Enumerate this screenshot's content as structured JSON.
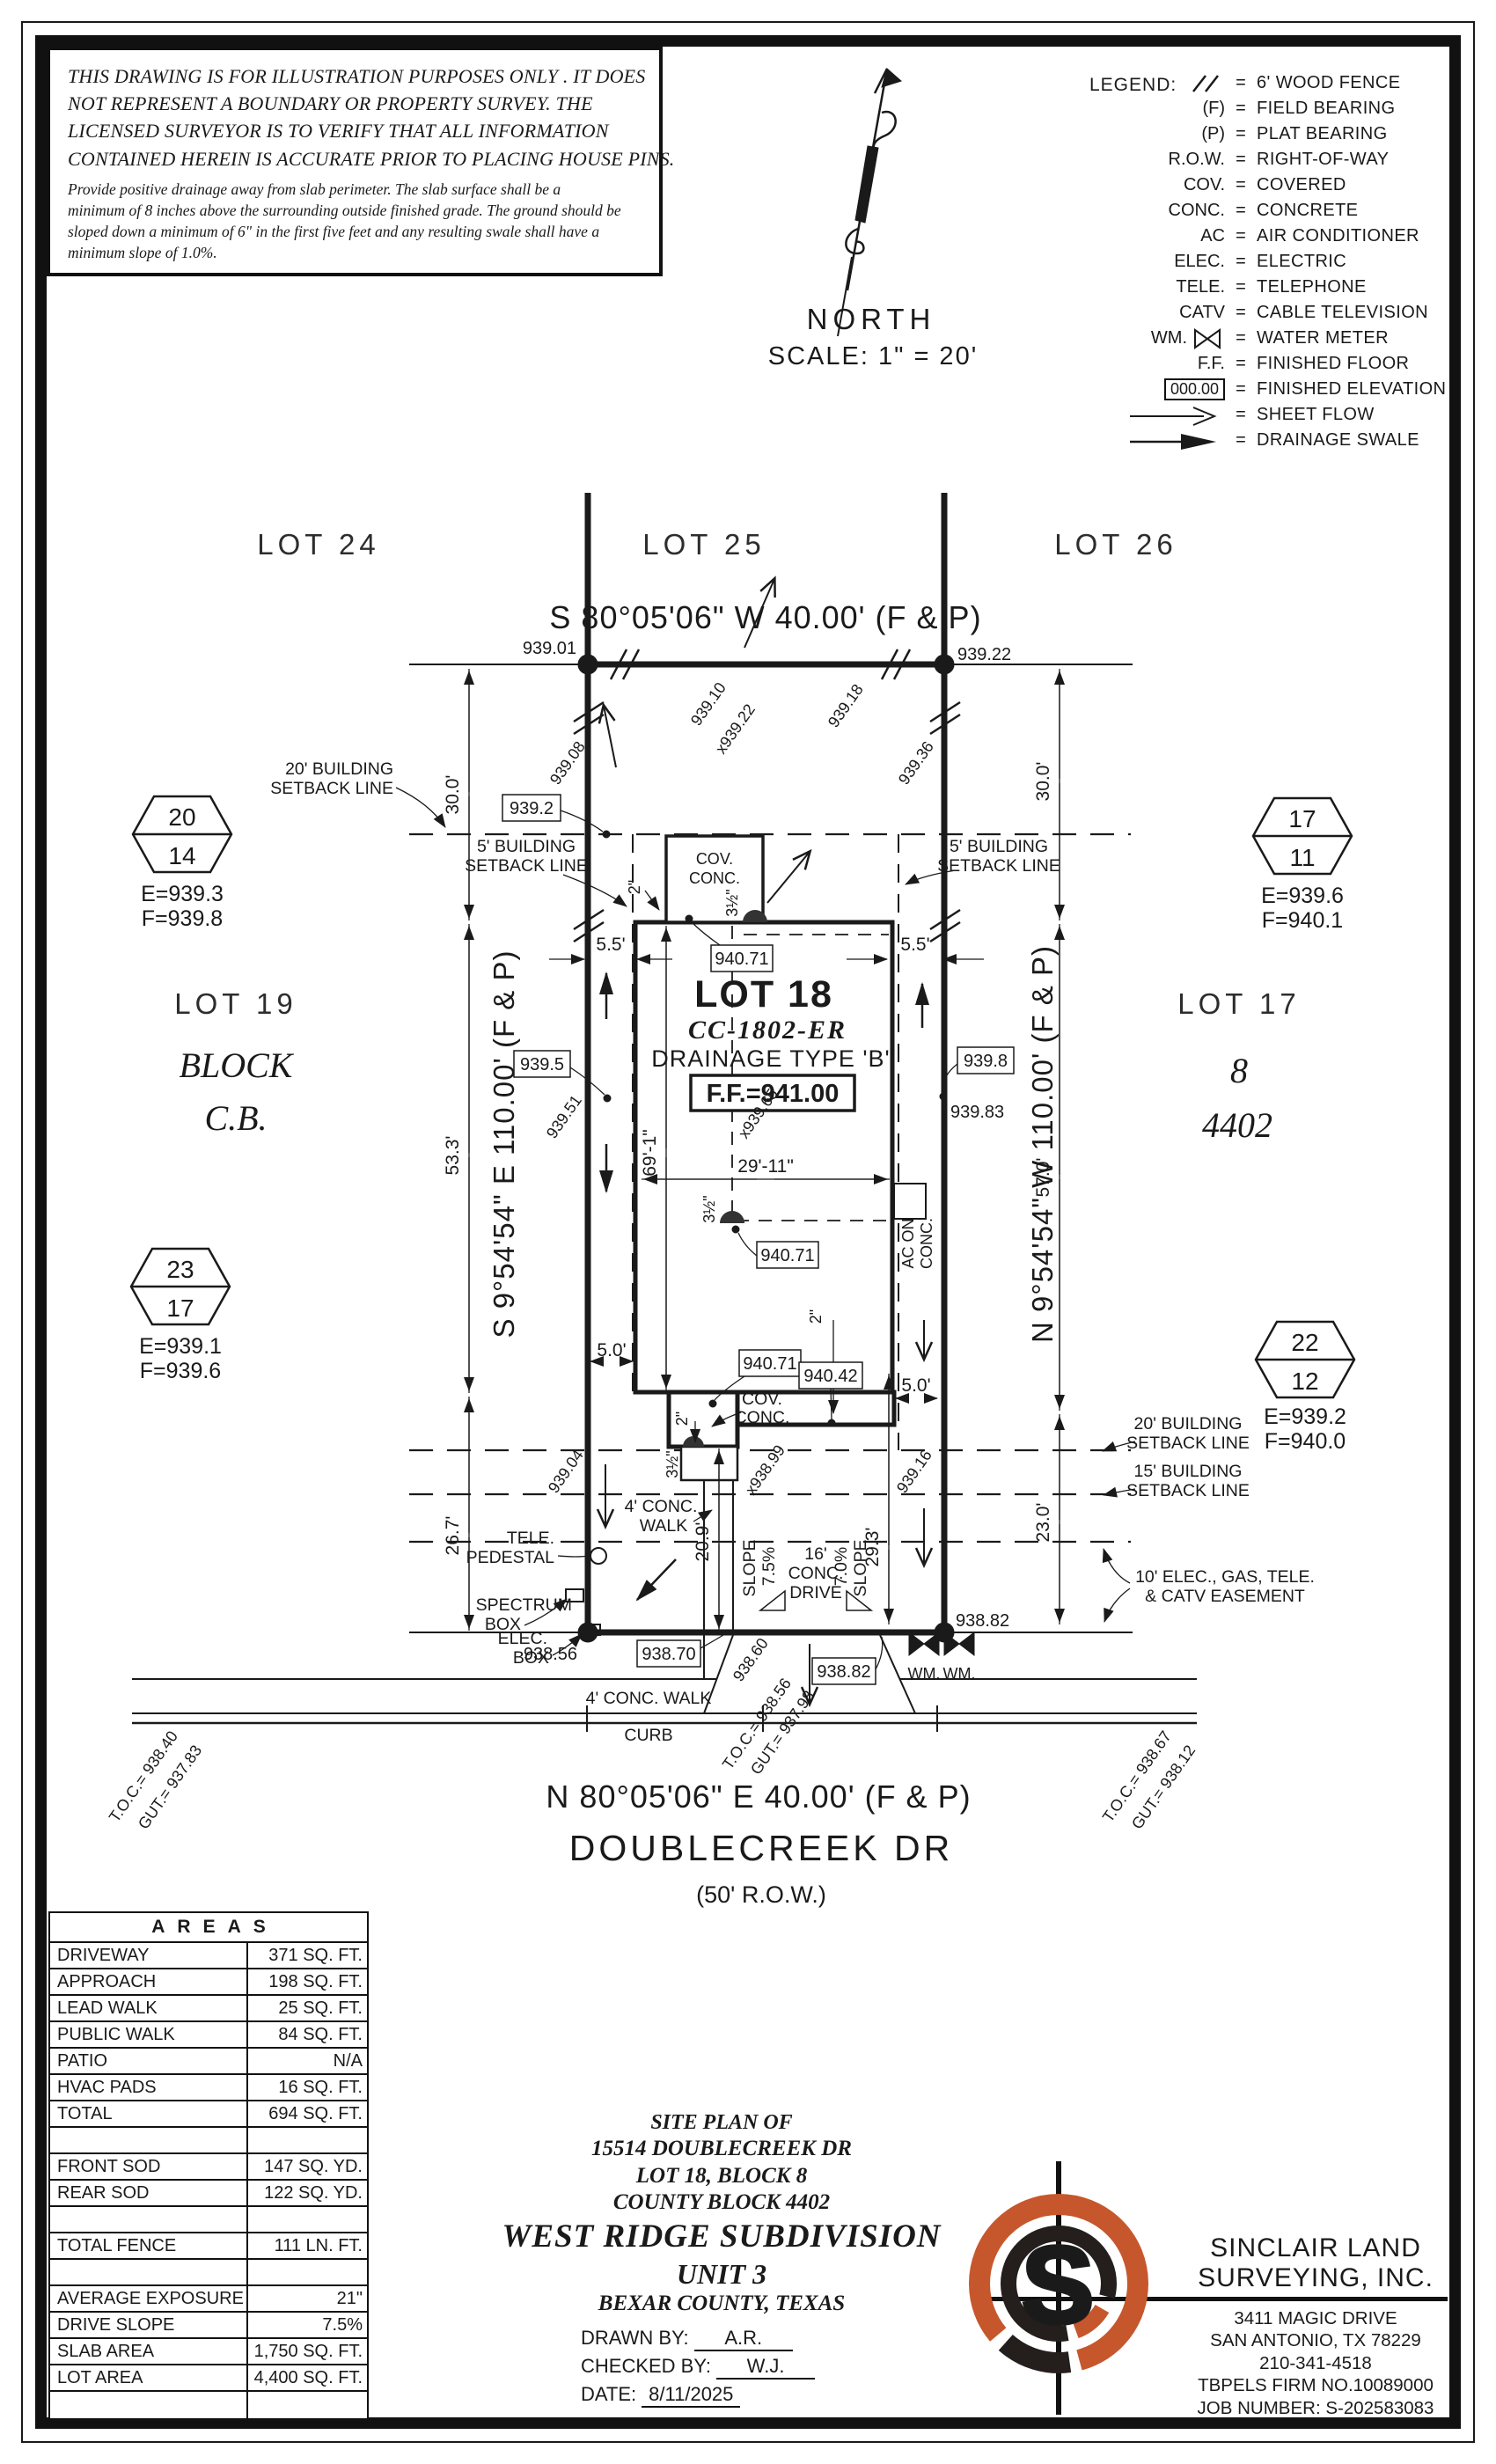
{
  "colors": {
    "ink": "#1a1a1a",
    "brand_orange": "#c6572c"
  },
  "disclaimer": {
    "caps": [
      "THIS DRAWING IS FOR ILLUSTRATION PURPOSES ONLY . IT DOES",
      "NOT REPRESENT A BOUNDARY OR PROPERTY SURVEY. THE",
      "LICENSED SURVEYOR IS TO VERIFY THAT ALL INFORMATION",
      "CONTAINED HEREIN IS ACCURATE PRIOR TO PLACING HOUSE PINS."
    ],
    "small": [
      "Provide positive drainage away from slab perimeter. The slab surface shall be a",
      "minimum of 8 inches above the surrounding outside finished grade. The ground should be",
      "sloped down a minimum of 6\" in the first five feet and any resulting swale shall have a",
      "minimum slope of 1.0%."
    ]
  },
  "north": {
    "label": "NORTH",
    "scale": "SCALE:  1\" =  20'"
  },
  "legend": {
    "title": "LEGEND:",
    "eq": "=",
    "rows": [
      {
        "sym": "",
        "label": "6' WOOD FENCE"
      },
      {
        "sym": "(F)",
        "label": "FIELD BEARING"
      },
      {
        "sym": "(P)",
        "label": "PLAT BEARING"
      },
      {
        "sym": "R.O.W.",
        "label": "RIGHT-OF-WAY"
      },
      {
        "sym": "COV.",
        "label": "COVERED"
      },
      {
        "sym": "CONC.",
        "label": "CONCRETE"
      },
      {
        "sym": "AC",
        "label": "AIR CONDITIONER"
      },
      {
        "sym": "ELEC.",
        "label": "ELECTRIC"
      },
      {
        "sym": "TELE.",
        "label": "TELEPHONE"
      },
      {
        "sym": "CATV",
        "label": "CABLE TELEVISION"
      },
      {
        "sym": "WM.",
        "label": "WATER METER"
      },
      {
        "sym": "F.F.",
        "label": "FINISHED FLOOR"
      },
      {
        "sym": "000.00",
        "label": "FINISHED ELEVATION"
      },
      {
        "sym": "",
        "label": "SHEET FLOW"
      },
      {
        "sym": "",
        "label": "DRAINAGE SWALE"
      }
    ]
  },
  "plan": {
    "lots": {
      "lot24": "LOT 24",
      "lot25": "LOT 25",
      "lot26": "LOT 26",
      "lot19": "LOT 19",
      "block_word": "BLOCK",
      "block_cb": "C.B.",
      "lot17": "LOT 17",
      "block8": "8",
      "cb4402": "4402"
    },
    "bearings": {
      "top": "S 80°05'06\" W 40.00' (F & P)",
      "bottom": "N 80°05'06\" E 40.00' (F & P)",
      "left": "S 9°54'54\" E 110.00' (F & P)",
      "right": "N 9°54'54\" W 110.00' (F & P)"
    },
    "street": {
      "name": "DOUBLECREEK DR",
      "row": "(50' R.O.W.)"
    },
    "house": {
      "lot": "LOT 18",
      "plan_no": "CC-1802-ER",
      "drainage": "DRAINAGE TYPE 'B'",
      "ff": "F.F.=941.00"
    },
    "setbacks": {
      "b20": "20' BUILDING",
      "b15": "15' BUILDING",
      "b5": "5' BUILDING",
      "sl": "SETBACK LINE",
      "e1": "10' ELEC., GAS, TELE.",
      "e2": "& CATV EASEMENT"
    },
    "dims": {
      "d30": "30.0'",
      "d533": "53.3'",
      "d267": "26.7'",
      "d57": "57.0'",
      "d23": "23.0'",
      "d209": "20.9'",
      "d293": "29.3'",
      "d55": "5.5'",
      "d50": "5.0'",
      "d2911": "29'-11\"",
      "d691": "69'-1\"",
      "d2": "2\"",
      "d35": "3½\""
    },
    "features": {
      "cov": "COV.",
      "conc": "CONC.",
      "acon": "AC ON",
      "tele": "TELE.",
      "ped": "PEDESTAL",
      "spectrum": "SPECTRUM",
      "box": "BOX",
      "elec": "ELEC.",
      "walk": "4' CONC. WALK",
      "walk1": "4' CONC.",
      "walk2": "WALK",
      "curb": "CURB",
      "slope": "SLOPE",
      "s75": "7.5%",
      "s70": "7.0%",
      "dr1": "16'",
      "dr2": "CONC.",
      "dr3": "DRIVE",
      "wm": "WM."
    },
    "spots_boxed": {
      "b1": "939.2",
      "b2": "940.71",
      "b3": "940.42",
      "b4": "939.5",
      "b5": "939.8",
      "b6": "938.70",
      "b7": "938.82"
    },
    "spots": {
      "c1": "939.01",
      "c2": "939.22",
      "c3": "938.56",
      "c4": "938.82",
      "c5": "939.83",
      "d1": "939.08",
      "d2": "939.10",
      "d3": "x939.22",
      "d4": "939.18",
      "d5": "939.36",
      "d6": "939.51",
      "d7": "x939.65",
      "d8": "939.04",
      "d9": "x938.99",
      "d10": "939.16",
      "d11": "938.60"
    },
    "markers": {
      "m1": {
        "n1": "20",
        "n2": "14",
        "e": "E=939.3",
        "f": "F=939.8"
      },
      "m2": {
        "n1": "23",
        "n2": "17",
        "e": "E=939.1",
        "f": "F=939.6"
      },
      "m3": {
        "n1": "17",
        "n2": "11",
        "e": "E=939.6",
        "f": "F=940.1"
      },
      "m4": {
        "n1": "22",
        "n2": "12",
        "e": "E=939.2",
        "f": "F=940.0"
      }
    },
    "toc": [
      {
        "a": "T.O.C.= 938.40",
        "b": "GUT.= 937.83"
      },
      {
        "a": "T.O.C.= 938.56",
        "b": "GUT.= 937.98"
      },
      {
        "a": "T.O.C.= 938.67",
        "b": "GUT.= 938.12"
      }
    ]
  },
  "areas": {
    "title": "AREAS",
    "rows": [
      {
        "l": "DRIVEWAY",
        "v": "371 SQ. FT."
      },
      {
        "l": "APPROACH",
        "v": "198 SQ. FT."
      },
      {
        "l": "LEAD WALK",
        "v": "25 SQ. FT."
      },
      {
        "l": "PUBLIC WALK",
        "v": "84 SQ. FT."
      },
      {
        "l": "PATIO",
        "v": "N/A"
      },
      {
        "l": "HVAC PADS",
        "v": "16 SQ. FT."
      },
      {
        "l": "TOTAL",
        "v": "694 SQ. FT."
      },
      {
        "l": "",
        "v": ""
      },
      {
        "l": "FRONT SOD",
        "v": "147 SQ. YD."
      },
      {
        "l": "REAR SOD",
        "v": "122 SQ. YD."
      },
      {
        "l": "",
        "v": ""
      },
      {
        "l": "TOTAL FENCE",
        "v": "111 LN. FT."
      },
      {
        "l": "",
        "v": ""
      },
      {
        "l": "AVERAGE EXPOSURE",
        "v": "21\""
      },
      {
        "l": "DRIVE SLOPE",
        "v": "7.5%"
      },
      {
        "l": "SLAB AREA",
        "v": "1,750 SQ. FT."
      },
      {
        "l": "LOT AREA",
        "v": "4,400 SQ. FT."
      },
      {
        "l": "",
        "v": ""
      }
    ]
  },
  "titleblock": {
    "l1": "SITE PLAN OF",
    "l2": "15514 DOUBLECREEK DR",
    "l3": "LOT 18, BLOCK 8",
    "l4": "COUNTY BLOCK 4402",
    "l5": "WEST RIDGE SUBDIVISION",
    "l6": "UNIT 3",
    "l7": "BEXAR COUNTY, TEXAS",
    "drawn_label": "DRAWN BY:",
    "drawn": "A.R.",
    "checked_label": "CHECKED BY:",
    "checked": "W.J.",
    "date_label": "DATE:",
    "date": "8/11/2025"
  },
  "surveyor": {
    "name1": "SINCLAIR LAND",
    "name2": "SURVEYING, INC.",
    "addr1": "3411 MAGIC DRIVE",
    "addr2": "SAN ANTONIO, TX 78229",
    "phone": "210-341-4518",
    "firm": "TBPELS FIRM NO.10089000",
    "job": "JOB NUMBER: S-202583083",
    "logo_letter": "S"
  }
}
